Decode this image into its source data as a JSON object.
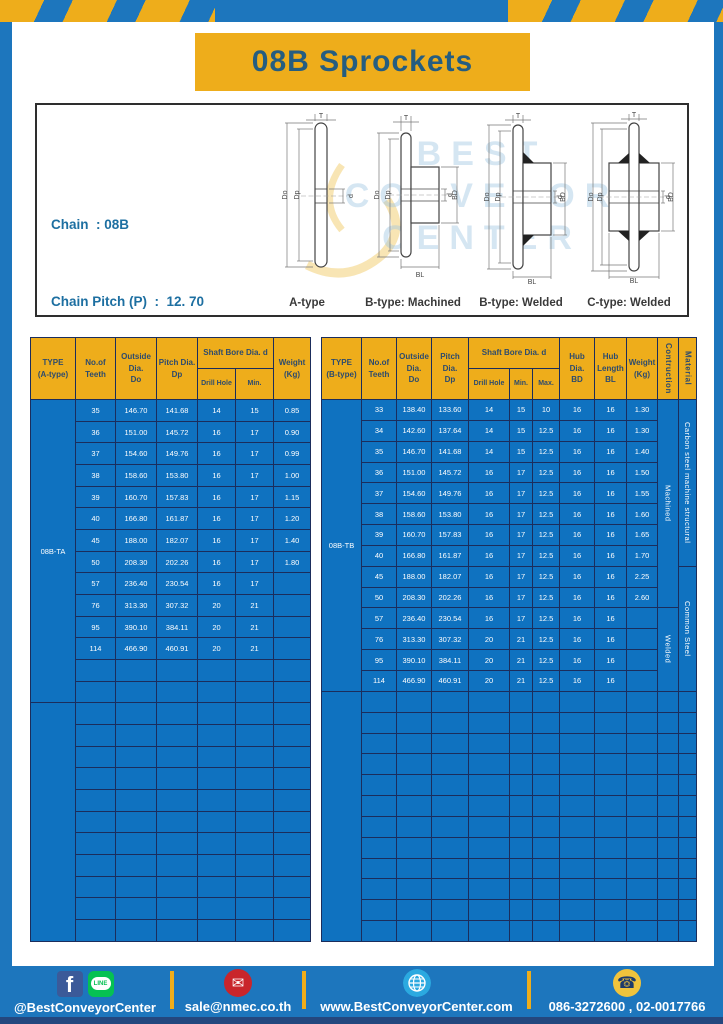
{
  "page": {
    "title": "08B Sprockets"
  },
  "colors": {
    "frame_blue": "#1d76bd",
    "table_cell_blue": "#0f72c0",
    "grid_navy": "#1b2d5c",
    "accent_yellow": "#eead1b",
    "header_text_navy": "#2d4b6d",
    "title_blue": "#255d80",
    "spec_text_blue": "#1d6fa1",
    "footer_strip_navy": "#24477e",
    "facebook_blue": "#3b5a99",
    "line_green": "#06c152",
    "mail_red": "#c9252b",
    "globe_blue": "#2ba9e0",
    "phone_yellow": "#f0c33c"
  },
  "specbox": {
    "lines": [
      "Chain  : 08B",
      "Chain Pitch (P)  :  12. 70",
      "Roller Link Inside Width (W)  :  7.75",
      "Roller Diameter (Dr)  : 8.51",
      "Teeth Width (T)  :  7.2"
    ]
  },
  "watermark": {
    "lines": [
      "BEST",
      "CONVEYOR",
      "CENTER"
    ]
  },
  "drawings": {
    "captions": [
      "A-type",
      "B-type: Machined",
      "B-type: Welded",
      "C-type: Welded"
    ],
    "dims": {
      "t": "T",
      "do": "Do",
      "dp": "Dp",
      "d": "d",
      "bd": "BD",
      "bl": "BL"
    }
  },
  "tables": {
    "left": {
      "type_value": "08B-TA",
      "col_widths": [
        45,
        40,
        41,
        41,
        38,
        38,
        37
      ],
      "header": [
        {
          "lines": [
            "TYPE",
            "(A-type)"
          ],
          "rowspan": 2
        },
        {
          "lines": [
            "No.of",
            "Teeth"
          ],
          "rowspan": 2
        },
        {
          "lines": [
            "Outside",
            "Dia.",
            "Do"
          ],
          "rowspan": 2
        },
        {
          "lines": [
            "Pitch Dia.",
            "Dp"
          ],
          "rowspan": 2
        },
        {
          "lines": [
            "Shaft Bore Dia. d"
          ],
          "colspan": 2
        },
        {
          "lines": [
            "Weight",
            "(Kg)"
          ],
          "rowspan": 2
        }
      ],
      "subheader": [
        "Drill Hole",
        "Min."
      ],
      "rows": [
        [
          "35",
          "146.70",
          "141.68",
          "14",
          "15",
          "0.85"
        ],
        [
          "36",
          "151.00",
          "145.72",
          "16",
          "17",
          "0.90"
        ],
        [
          "37",
          "154.60",
          "149.76",
          "16",
          "17",
          "0.99"
        ],
        [
          "38",
          "158.60",
          "153.80",
          "16",
          "17",
          "1.00"
        ],
        [
          "39",
          "160.70",
          "157.83",
          "16",
          "17",
          "1.15"
        ],
        [
          "40",
          "166.80",
          "161.87",
          "16",
          "17",
          "1.20"
        ],
        [
          "45",
          "188.00",
          "182.07",
          "16",
          "17",
          "1.40"
        ],
        [
          "50",
          "208.30",
          "202.26",
          "16",
          "17",
          "1.80"
        ],
        [
          "57",
          "236.40",
          "230.54",
          "16",
          "17",
          ""
        ],
        [
          "76",
          "313.30",
          "307.32",
          "20",
          "21",
          ""
        ],
        [
          "95",
          "390.10",
          "384.11",
          "20",
          "21",
          ""
        ],
        [
          "114",
          "466.90",
          "460.91",
          "20",
          "21",
          ""
        ]
      ],
      "empty_rows_in_section": 2,
      "empty_section_rows": 11
    },
    "right": {
      "type_value": "08B-TB",
      "col_widths": [
        40,
        35,
        35,
        37,
        41,
        23,
        27,
        35,
        32,
        31,
        21,
        18
      ],
      "header": [
        {
          "lines": [
            "TYPE",
            "(B-type)"
          ],
          "rowspan": 2
        },
        {
          "lines": [
            "No.of",
            "Teeth"
          ],
          "rowspan": 2
        },
        {
          "lines": [
            "Outside",
            "Dia.",
            "Do"
          ],
          "rowspan": 2
        },
        {
          "lines": [
            "Pitch Dia.",
            "Dp"
          ],
          "rowspan": 2
        },
        {
          "lines": [
            "Shaft Bore Dia. d"
          ],
          "colspan": 3
        },
        {
          "lines": [
            "Hub Dia.",
            "BD"
          ],
          "rowspan": 2
        },
        {
          "lines": [
            "Hub",
            "Length",
            "BL"
          ],
          "rowspan": 2
        },
        {
          "lines": [
            "Weight",
            "(Kg)"
          ],
          "rowspan": 2
        },
        {
          "lines": [
            "Contruction"
          ],
          "rowspan": 2,
          "vertical": true
        },
        {
          "lines": [
            "Material"
          ],
          "rowspan": 2,
          "vertical": true
        }
      ],
      "subheader": [
        "Drill Hole",
        "Min.",
        "Max."
      ],
      "rows": [
        [
          "33",
          "138.40",
          "133.60",
          "14",
          "15",
          "10",
          "16",
          "16",
          "1.30"
        ],
        [
          "34",
          "142.60",
          "137.64",
          "14",
          "15",
          "12.5",
          "16",
          "16",
          "1.30"
        ],
        [
          "35",
          "146.70",
          "141.68",
          "14",
          "15",
          "12.5",
          "16",
          "16",
          "1.40"
        ],
        [
          "36",
          "151.00",
          "145.72",
          "16",
          "17",
          "12.5",
          "16",
          "16",
          "1.50"
        ],
        [
          "37",
          "154.60",
          "149.76",
          "16",
          "17",
          "12.5",
          "16",
          "16",
          "1.55"
        ],
        [
          "38",
          "158.60",
          "153.80",
          "16",
          "17",
          "12.5",
          "16",
          "16",
          "1.60"
        ],
        [
          "39",
          "160.70",
          "157.83",
          "16",
          "17",
          "12.5",
          "16",
          "16",
          "1.65"
        ],
        [
          "40",
          "166.80",
          "161.87",
          "16",
          "17",
          "12.5",
          "16",
          "16",
          "1.70"
        ],
        [
          "45",
          "188.00",
          "182.07",
          "16",
          "17",
          "12.5",
          "16",
          "16",
          "2.25"
        ],
        [
          "50",
          "208.30",
          "202.26",
          "16",
          "17",
          "12.5",
          "16",
          "16",
          "2.60"
        ],
        [
          "57",
          "236.40",
          "230.54",
          "16",
          "17",
          "12.5",
          "16",
          "16",
          ""
        ],
        [
          "76",
          "313.30",
          "307.32",
          "20",
          "21",
          "12.5",
          "16",
          "16",
          ""
        ],
        [
          "95",
          "390.10",
          "384.11",
          "20",
          "21",
          "12.5",
          "16",
          "16",
          ""
        ],
        [
          "114",
          "466.90",
          "460.91",
          "20",
          "21",
          "12.5",
          "16",
          "16",
          ""
        ]
      ],
      "empty_rows_in_section": 0,
      "empty_section_rows": 12,
      "span_cols": [
        {
          "name": "construction",
          "spans": [
            {
              "label": "Machined",
              "start": 0,
              "count": 10
            },
            {
              "label": "Welded",
              "start": 10,
              "count": 4
            }
          ]
        },
        {
          "name": "material",
          "spans": [
            {
              "label": "Carbon steel machine structural",
              "start": 0,
              "count": 8
            },
            {
              "label": "Common Steel",
              "start": 8,
              "count": 6
            }
          ]
        }
      ]
    }
  },
  "footer": {
    "social_handle": "@BestConveyorCenter",
    "line_text": "LINE",
    "facebook_letter": "f",
    "email": "sale@nmec.co.th",
    "email_glyph": "✉",
    "website": "www.BestConveyorCenter.com",
    "phone": "086-3272600 , 02-0017766",
    "phone_glyph": "☎",
    "icons": [
      "facebook-icon",
      "line-icon",
      "email-envelope-icon",
      "globe-icon",
      "phone-icon"
    ]
  }
}
